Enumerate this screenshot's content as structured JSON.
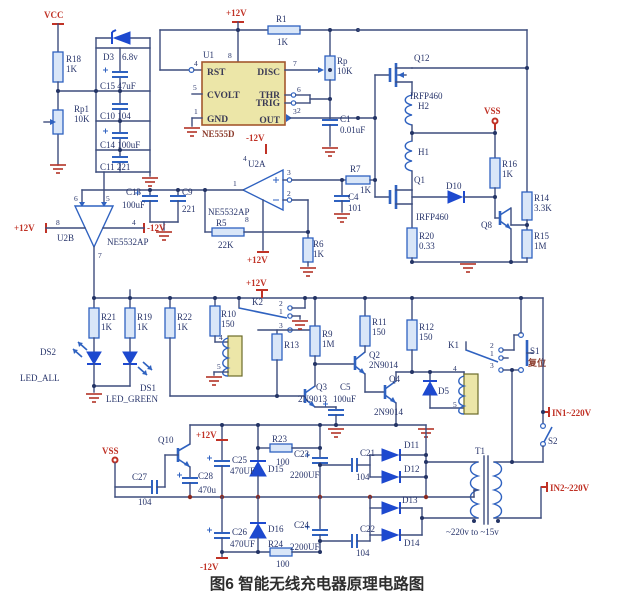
{
  "caption": "图6  智能无线充电器原理电路图",
  "colors": {
    "wire": "#3d4d7d",
    "component_stroke": "#2f62c0",
    "diode_fill": "#1d49cf",
    "power_red": "#c03226",
    "chip_fill": "#ece6a8",
    "label_navy": "#28356b"
  },
  "t": {
    "vcc": "VCC",
    "r18": "R18",
    "r18v": "1K",
    "rp1": "Rp1",
    "rp1v": "10K",
    "d3": "D3",
    "d3v": "6.8v",
    "c15": "C15 47uF",
    "c10": "C10 104",
    "c14": "C14 100uF",
    "c11": "C11 221",
    "p12_555": "+12V",
    "m12_555": "-12V",
    "r1": "R1",
    "r1v": "1K",
    "rp": "Rp",
    "rpv": "10K",
    "u1": "U1",
    "pin8": "8",
    "rst": "RST",
    "cvolt": "CVOLT",
    "gnd": "GND",
    "disc": "DISC",
    "thr": "THR",
    "trig": "TRIG",
    "out": "OUT",
    "ne555d": "NE555D",
    "p4": "4",
    "p5": "5",
    "p1": "1",
    "p7": "7",
    "p6": "6",
    "p2": "2",
    "p3": "3",
    "c1": "C1",
    "c1v": "0.01uF",
    "q12": "Q12",
    "irfp460a": "IRFP460",
    "h2": "H2",
    "h1": "H1",
    "vss1": "VSS",
    "q1": "Q1",
    "irfp460b": "IRFP460",
    "r20": "R20",
    "r20v": "0.33",
    "d10": "D10",
    "r16": "R16",
    "r16v": "1K",
    "q8": "Q8",
    "r14": "R14",
    "r14v": "3.3K",
    "r15": "R15",
    "r15v": "1M",
    "u2a": "U2A",
    "ne5532a": "NE5532AP",
    "u2a_p3": "3",
    "u2a_p2": "2",
    "u2a_p1": "1",
    "u2a_p4": "4",
    "u2a_p8": "8",
    "p12_u2a": "+12V",
    "r7": "R7",
    "r7v": "1K",
    "c4": "C4",
    "c4v": "101",
    "r5": "R5",
    "r5v": "22K",
    "r6": "R6",
    "r6v": "1K",
    "c13": "C13",
    "c13v": "100uF",
    "c9": "C9",
    "c9v": "221",
    "u2b": "U2B",
    "ne5532b": "NE5532AP",
    "p12_u2b": "+12V",
    "m12_u2b": "-12V",
    "u2b_p8": "8",
    "u2b_p4": "4",
    "u2b_p6": "6",
    "u2b_p5": "5",
    "u2b_p7": "7",
    "r21": "R21",
    "r21v": "1K",
    "r19": "R19",
    "r19v": "1K",
    "r22": "R22",
    "r22v": "1K",
    "ds2": "DS2",
    "led_all": "LED_ALL",
    "ds1": "DS1",
    "led_green": "LED_GREEN",
    "p12_rail": "+12V",
    "k2": "K2",
    "k2_p2": "2",
    "k2_p1": "1",
    "k2_p3": "3",
    "k2_p4": "4",
    "k2_p5": "5",
    "r10": "R10",
    "r10v": "150",
    "r13": "R13",
    "r9": "R9",
    "r9v": "1M",
    "r11": "R11",
    "r11v": "150",
    "r12": "R12",
    "r12v": "150",
    "q2": "Q2",
    "q2t": "2N9014",
    "q3": "Q3",
    "q3t": "2N9013",
    "c5": "C5",
    "c5v": "100uF",
    "q4": "Q4",
    "q4t": "2N9014",
    "d5": "D5",
    "k1": "K1",
    "k1_p2": "2",
    "k1_p1": "1",
    "k1_p3": "3",
    "k1_p4": "4",
    "k1_p5": "5",
    "s1": "S1",
    "s1cn": "复位",
    "in1": "IN1~220V",
    "s2": "S2",
    "in2": "IN2~220V",
    "q10": "Q10",
    "p12_bl": "+12V",
    "m12_bl": "-12V",
    "vss2": "VSS",
    "c25": "C25",
    "c25v": "470UF",
    "c27": "C27",
    "c27v": "104",
    "c28": "C28",
    "c28v": "470u",
    "c26": "C26",
    "c26v": "470UF",
    "d15": "D15",
    "d16": "D16",
    "r23": "R23",
    "r23v": "100",
    "r24": "R24",
    "r24v": "100",
    "c23": "C23",
    "c23v": "2200UF",
    "c21": "C21",
    "c21v": "104",
    "c24": "C24",
    "c24v": "2200UF",
    "c22": "C22",
    "c22v": "104",
    "d11": "D11",
    "d12": "D12",
    "d13": "D13",
    "d14": "D14",
    "t1": "T1",
    "t1v": "~220v to ~15v"
  }
}
